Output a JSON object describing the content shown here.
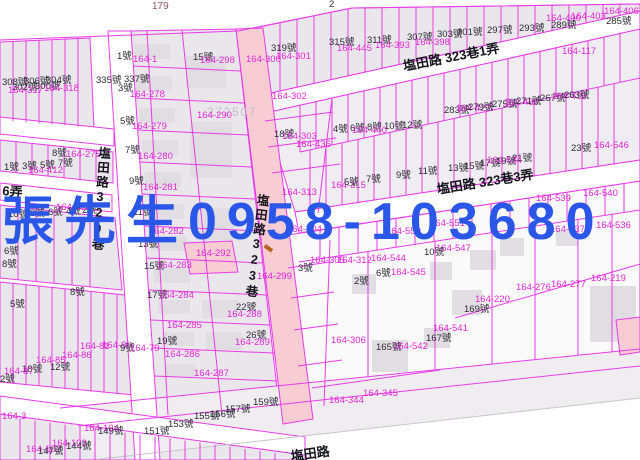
{
  "watermark": {
    "text": "張先生0958-103680",
    "color": "#2b57e8"
  },
  "map": {
    "colors": {
      "background": "#ffffff",
      "parcel_line": "#e93be9",
      "parcel_label": "#e226d6",
      "house_label": "#2b2b33",
      "road_fill": "#f7ccd3",
      "block_fill": "#eae7ec",
      "building_fill": "#e0dde3",
      "street_label": "#14141c",
      "sheet_gray": "#c3bfc8",
      "ref_brown": "#8a5660",
      "watermark_blue": "#2b57e8"
    },
    "streets": [
      {
        "t": "塩田路 323巷1弄",
        "x": 402,
        "y": 60,
        "r": -11
      },
      {
        "t": "塩田路 323巷3弄",
        "x": 436,
        "y": 183,
        "r": -9
      },
      {
        "t": "塩田路329巷",
        "x": 97,
        "y": 146,
        "v": true,
        "r": 4
      },
      {
        "t": "塩田路323巷",
        "x": 256,
        "y": 193,
        "v": true,
        "r": 7
      },
      {
        "t": "6弄",
        "x": 3,
        "y": 184,
        "r": 5
      },
      {
        "t": "塩田路",
        "x": 290,
        "y": 450,
        "r": -8
      }
    ],
    "labels": [
      {
        "t": "179",
        "c": "g2",
        "x": 152,
        "y": 2
      },
      {
        "t": "2",
        "c": "h",
        "x": 329,
        "y": 0
      },
      {
        "t": "272507",
        "c": "g",
        "x": 207,
        "y": 108
      },
      {
        "t": "319號",
        "c": "h",
        "x": 271,
        "y": 44
      },
      {
        "t": "164-300",
        "c": "p",
        "x": 246,
        "y": 55
      },
      {
        "t": "164-301",
        "c": "p",
        "x": 276,
        "y": 52
      },
      {
        "t": "315號",
        "c": "h",
        "x": 329,
        "y": 38
      },
      {
        "t": "164-445",
        "c": "p",
        "x": 337,
        "y": 44
      },
      {
        "t": "311號",
        "c": "h",
        "x": 367,
        "y": 36
      },
      {
        "t": "164-393",
        "c": "p",
        "x": 375,
        "y": 41
      },
      {
        "t": "307號",
        "c": "h",
        "x": 407,
        "y": 33
      },
      {
        "t": "164-398",
        "c": "p",
        "x": 415,
        "y": 38
      },
      {
        "t": "303號",
        "c": "h",
        "x": 437,
        "y": 30
      },
      {
        "t": "301號",
        "c": "h",
        "x": 457,
        "y": 28
      },
      {
        "t": "297號",
        "c": "h",
        "x": 487,
        "y": 26
      },
      {
        "t": "293號",
        "c": "h",
        "x": 519,
        "y": 24
      },
      {
        "t": "164-400",
        "c": "p",
        "x": 546,
        "y": 14
      },
      {
        "t": "289號",
        "c": "h",
        "x": 551,
        "y": 21
      },
      {
        "t": "164-403",
        "c": "p",
        "x": 571,
        "y": 12
      },
      {
        "t": "285號",
        "c": "h",
        "x": 606,
        "y": 17
      },
      {
        "t": "164-406",
        "c": "p",
        "x": 604,
        "y": 7
      },
      {
        "t": "164-117",
        "c": "p",
        "x": 562,
        "y": 47
      },
      {
        "t": "308號",
        "c": "h",
        "x": 2,
        "y": 78
      },
      {
        "t": "306號",
        "c": "h",
        "x": 24,
        "y": 77
      },
      {
        "t": "304號",
        "c": "h",
        "x": 46,
        "y": 76
      },
      {
        "t": "302號",
        "c": "h",
        "x": 12,
        "y": 83
      },
      {
        "t": "300號",
        "c": "h",
        "x": 35,
        "y": 82
      },
      {
        "t": "164-317",
        "c": "p",
        "x": 8,
        "y": 86
      },
      {
        "t": "164-318",
        "c": "p",
        "x": 44,
        "y": 84
      },
      {
        "t": "335號",
        "c": "h",
        "x": 96,
        "y": 76
      },
      {
        "t": "337號",
        "c": "h",
        "x": 124,
        "y": 75
      },
      {
        "t": "1號",
        "c": "h",
        "x": 117,
        "y": 52
      },
      {
        "t": "164-1",
        "c": "p",
        "x": 133,
        "y": 55
      },
      {
        "t": "15號",
        "c": "h",
        "x": 193,
        "y": 53
      },
      {
        "t": "164-298",
        "c": "p",
        "x": 200,
        "y": 56
      },
      {
        "t": "3號",
        "c": "h",
        "x": 118,
        "y": 84
      },
      {
        "t": "164-278",
        "c": "p",
        "x": 130,
        "y": 90
      },
      {
        "t": "5號",
        "c": "h",
        "x": 120,
        "y": 117
      },
      {
        "t": "164-279",
        "c": "p",
        "x": 132,
        "y": 122
      },
      {
        "t": "164-290",
        "c": "p",
        "x": 197,
        "y": 111
      },
      {
        "t": "7號",
        "c": "h",
        "x": 125,
        "y": 146
      },
      {
        "t": "164-280",
        "c": "p",
        "x": 138,
        "y": 152
      },
      {
        "t": "9號",
        "c": "h",
        "x": 129,
        "y": 177
      },
      {
        "t": "164-281",
        "c": "p",
        "x": 143,
        "y": 183
      },
      {
        "t": "11號",
        "c": "h",
        "x": 133,
        "y": 208
      },
      {
        "t": "164-282",
        "c": "p",
        "x": 149,
        "y": 227
      },
      {
        "t": "13號",
        "c": "h",
        "x": 138,
        "y": 240
      },
      {
        "t": "15號",
        "c": "h",
        "x": 144,
        "y": 262
      },
      {
        "t": "164-283",
        "c": "p",
        "x": 157,
        "y": 261
      },
      {
        "t": "164-292",
        "c": "p",
        "x": 196,
        "y": 249
      },
      {
        "t": "17號",
        "c": "h",
        "x": 147,
        "y": 291
      },
      {
        "t": "164-284",
        "c": "p",
        "x": 159,
        "y": 291
      },
      {
        "t": "19號",
        "c": "h",
        "x": 157,
        "y": 337
      },
      {
        "t": "164-285",
        "c": "p",
        "x": 167,
        "y": 321
      },
      {
        "t": "164-286",
        "c": "p",
        "x": 165,
        "y": 350
      },
      {
        "t": "164-287",
        "c": "p",
        "x": 194,
        "y": 369
      },
      {
        "t": "22號",
        "c": "h",
        "x": 236,
        "y": 303
      },
      {
        "t": "164-288",
        "c": "p",
        "x": 227,
        "y": 310
      },
      {
        "t": "26號",
        "c": "h",
        "x": 246,
        "y": 331
      },
      {
        "t": "164-289",
        "c": "p",
        "x": 235,
        "y": 338
      },
      {
        "t": "1號",
        "c": "h",
        "x": 4,
        "y": 163
      },
      {
        "t": "3號",
        "c": "h",
        "x": 22,
        "y": 162
      },
      {
        "t": "5號",
        "c": "h",
        "x": 40,
        "y": 161
      },
      {
        "t": "7號",
        "c": "h",
        "x": 58,
        "y": 159
      },
      {
        "t": "164-412",
        "c": "p",
        "x": 28,
        "y": 166
      },
      {
        "t": "8號",
        "c": "h",
        "x": 52,
        "y": 149
      },
      {
        "t": "164-275",
        "c": "p",
        "x": 66,
        "y": 150
      },
      {
        "t": "10號",
        "c": "h",
        "x": 8,
        "y": 210
      },
      {
        "t": "8號",
        "c": "h",
        "x": 30,
        "y": 209
      },
      {
        "t": "6號",
        "c": "h",
        "x": 48,
        "y": 208
      },
      {
        "t": "164-464",
        "c": "p",
        "x": 56,
        "y": 203
      },
      {
        "t": "4號",
        "c": "h",
        "x": 66,
        "y": 207
      },
      {
        "t": "2號",
        "c": "h",
        "x": 82,
        "y": 206
      },
      {
        "t": "6號",
        "c": "h",
        "x": 4,
        "y": 247
      },
      {
        "t": "8號",
        "c": "h",
        "x": 2,
        "y": 260
      },
      {
        "t": "8號",
        "c": "h",
        "x": 70,
        "y": 288
      },
      {
        "t": "5號",
        "c": "h",
        "x": 10,
        "y": 300
      },
      {
        "t": "164-81",
        "c": "p",
        "x": 80,
        "y": 342
      },
      {
        "t": "164-80",
        "c": "p",
        "x": 102,
        "y": 341
      },
      {
        "t": "9號",
        "c": "h",
        "x": 120,
        "y": 344
      },
      {
        "t": "164-79",
        "c": "p",
        "x": 130,
        "y": 344
      },
      {
        "t": "164-86",
        "c": "p",
        "x": 62,
        "y": 351
      },
      {
        "t": "164-85",
        "c": "p",
        "x": 36,
        "y": 356
      },
      {
        "t": "12號",
        "c": "h",
        "x": 50,
        "y": 363
      },
      {
        "t": "18號",
        "c": "h",
        "x": 22,
        "y": 365
      },
      {
        "t": "164-87",
        "c": "p",
        "x": 4,
        "y": 367
      },
      {
        "t": "2號",
        "c": "h",
        "x": 0,
        "y": 375
      },
      {
        "t": "164-3",
        "c": "p",
        "x": 2,
        "y": 412
      },
      {
        "t": "164-104",
        "c": "p",
        "x": 84,
        "y": 424
      },
      {
        "t": "149號",
        "c": "h",
        "x": 98,
        "y": 427
      },
      {
        "t": "151號",
        "c": "h",
        "x": 144,
        "y": 427
      },
      {
        "t": "153號",
        "c": "h",
        "x": 168,
        "y": 420
      },
      {
        "t": "164-103",
        "c": "p",
        "x": 52,
        "y": 439
      },
      {
        "t": "144號",
        "c": "h",
        "x": 66,
        "y": 442
      },
      {
        "t": "164-102",
        "c": "p",
        "x": 26,
        "y": 445
      },
      {
        "t": "147號",
        "c": "h",
        "x": 38,
        "y": 447
      },
      {
        "t": "155號",
        "c": "h",
        "x": 194,
        "y": 412
      },
      {
        "t": "156號",
        "c": "h",
        "x": 210,
        "y": 410
      },
      {
        "t": "157號",
        "c": "h",
        "x": 225,
        "y": 405
      },
      {
        "t": "159號",
        "c": "h",
        "x": 253,
        "y": 398
      },
      {
        "t": "164-302",
        "c": "p",
        "x": 272,
        "y": 92
      },
      {
        "t": "18號",
        "c": "h",
        "x": 274,
        "y": 130
      },
      {
        "t": "164-303",
        "c": "p",
        "x": 282,
        "y": 132
      },
      {
        "t": "164-436",
        "c": "p",
        "x": 296,
        "y": 140
      },
      {
        "t": "164-313",
        "c": "p",
        "x": 282,
        "y": 188
      },
      {
        "t": "164-304",
        "c": "p",
        "x": 287,
        "y": 225
      },
      {
        "t": "164-299",
        "c": "p",
        "x": 257,
        "y": 272
      },
      {
        "t": "3號",
        "c": "h",
        "x": 298,
        "y": 264
      },
      {
        "t": "164-305",
        "c": "p",
        "x": 310,
        "y": 256
      },
      {
        "t": "283號",
        "c": "h",
        "x": 444,
        "y": 106
      },
      {
        "t": "164-427",
        "c": "p",
        "x": 456,
        "y": 104
      },
      {
        "t": "279號",
        "c": "h",
        "x": 468,
        "y": 103
      },
      {
        "t": "275號",
        "c": "h",
        "x": 492,
        "y": 100
      },
      {
        "t": "164-430",
        "c": "p",
        "x": 504,
        "y": 98
      },
      {
        "t": "271號",
        "c": "h",
        "x": 516,
        "y": 97
      },
      {
        "t": "267號",
        "c": "h",
        "x": 540,
        "y": 94
      },
      {
        "t": "164-433",
        "c": "p",
        "x": 552,
        "y": 92
      },
      {
        "t": "263號",
        "c": "h",
        "x": 564,
        "y": 91
      },
      {
        "t": "4號",
        "c": "h",
        "x": 333,
        "y": 125
      },
      {
        "t": "6號",
        "c": "h",
        "x": 350,
        "y": 124
      },
      {
        "t": "8號",
        "c": "h",
        "x": 367,
        "y": 123
      },
      {
        "t": "10號",
        "c": "h",
        "x": 384,
        "y": 122
      },
      {
        "t": "12號",
        "c": "h",
        "x": 402,
        "y": 121
      },
      {
        "t": "164-440",
        "c": "p",
        "x": 352,
        "y": 126
      },
      {
        "t": "164-315",
        "c": "p",
        "x": 331,
        "y": 181
      },
      {
        "t": "5號",
        "c": "h",
        "x": 344,
        "y": 178
      },
      {
        "t": "7號",
        "c": "h",
        "x": 366,
        "y": 175
      },
      {
        "t": "9號",
        "c": "h",
        "x": 396,
        "y": 171
      },
      {
        "t": "11號",
        "c": "h",
        "x": 418,
        "y": 167
      },
      {
        "t": "13號",
        "c": "h",
        "x": 448,
        "y": 164
      },
      {
        "t": "15號",
        "c": "h",
        "x": 464,
        "y": 162
      },
      {
        "t": "17號",
        "c": "h",
        "x": 480,
        "y": 159
      },
      {
        "t": "19號",
        "c": "h",
        "x": 496,
        "y": 157
      },
      {
        "t": "21號",
        "c": "h",
        "x": 512,
        "y": 154
      },
      {
        "t": "164-534",
        "c": "p",
        "x": 487,
        "y": 156
      },
      {
        "t": "23號",
        "c": "h",
        "x": 571,
        "y": 144
      },
      {
        "t": "164-546",
        "c": "p",
        "x": 594,
        "y": 141
      },
      {
        "t": "164-550",
        "c": "p",
        "x": 386,
        "y": 227
      },
      {
        "t": "164-551",
        "c": "p",
        "x": 430,
        "y": 219
      },
      {
        "t": "164-537",
        "c": "p",
        "x": 550,
        "y": 225
      },
      {
        "t": "164-536",
        "c": "p",
        "x": 596,
        "y": 221
      },
      {
        "t": "164-540",
        "c": "p",
        "x": 583,
        "y": 189
      },
      {
        "t": "164-539",
        "c": "p",
        "x": 536,
        "y": 194
      },
      {
        "t": "164-312",
        "c": "p",
        "x": 337,
        "y": 256
      },
      {
        "t": "164-544",
        "c": "p",
        "x": 371,
        "y": 254
      },
      {
        "t": "164-545",
        "c": "p",
        "x": 391,
        "y": 268
      },
      {
        "t": "164-547",
        "c": "p",
        "x": 436,
        "y": 244
      },
      {
        "t": "10號",
        "c": "h",
        "x": 424,
        "y": 248
      },
      {
        "t": "2號",
        "c": "h",
        "x": 354,
        "y": 277
      },
      {
        "t": "6號",
        "c": "h",
        "x": 376,
        "y": 269
      },
      {
        "t": "164-276",
        "c": "p",
        "x": 516,
        "y": 283
      },
      {
        "t": "164-277",
        "c": "p",
        "x": 551,
        "y": 280
      },
      {
        "t": "164-219",
        "c": "p",
        "x": 591,
        "y": 274
      },
      {
        "t": "164-220",
        "c": "p",
        "x": 475,
        "y": 295
      },
      {
        "t": "169號",
        "c": "h",
        "x": 464,
        "y": 305
      },
      {
        "t": "164-541",
        "c": "p",
        "x": 433,
        "y": 324
      },
      {
        "t": "167號",
        "c": "h",
        "x": 426,
        "y": 334
      },
      {
        "t": "164-306",
        "c": "p",
        "x": 331,
        "y": 336
      },
      {
        "t": "165號",
        "c": "h",
        "x": 376,
        "y": 343
      },
      {
        "t": "164-542",
        "c": "p",
        "x": 393,
        "y": 342
      },
      {
        "t": "164-344",
        "c": "p",
        "x": 329,
        "y": 396
      },
      {
        "t": "164-345",
        "c": "p",
        "x": 363,
        "y": 389
      }
    ]
  }
}
